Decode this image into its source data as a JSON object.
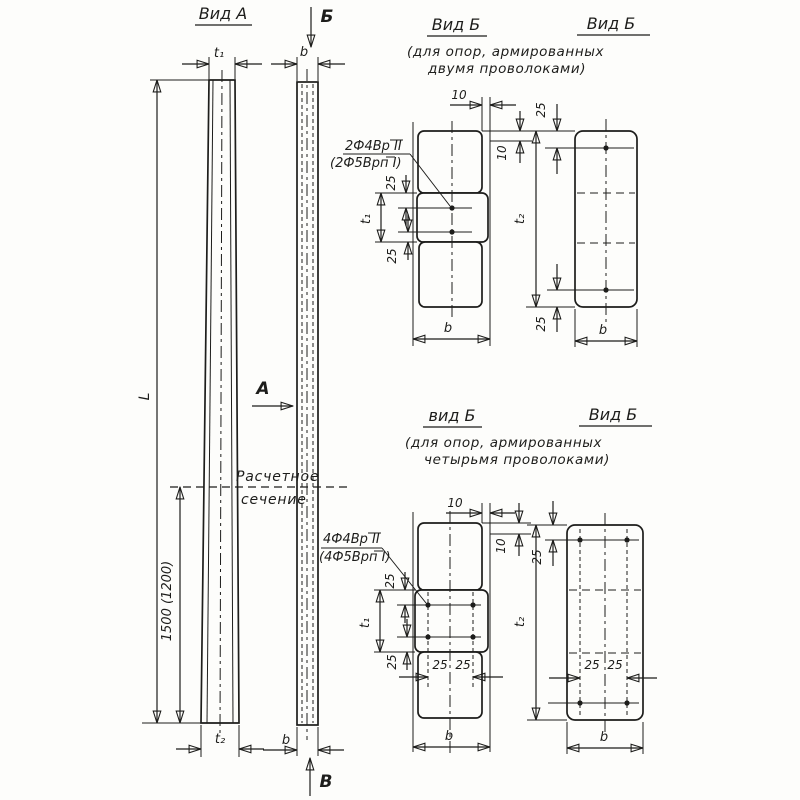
{
  "pole_front": {
    "title": "Вид А",
    "dim_length": "L",
    "dim_calc": "1500 (1200)",
    "calc_line1": "Расчетное",
    "calc_line2": "сечение"
  },
  "pole_side": {
    "marker_top": "Б",
    "marker_bottom": "В",
    "marker_section": "А"
  },
  "dims": {
    "d10": "10",
    "d25": "25",
    "t1": "t₁",
    "t2": "t₂",
    "b": "b"
  },
  "two_wire": {
    "title_left": "Вид Б",
    "subtitle1": "(для опор, армированных",
    "subtitle2": "двумя  проволоками)",
    "title_right": "Вид Б",
    "rebar1": "2Ф4Вр II",
    "rebar2": "(2Ф5Врп I)"
  },
  "four_wire": {
    "title_left": "вид Б",
    "subtitle1": "(для опор, армированных",
    "subtitle2": "четырьмя  проволоками)",
    "title_right": "Вид Б",
    "rebar1": "4Ф4Вр II",
    "rebar2": "(4Ф5Врп I)"
  }
}
